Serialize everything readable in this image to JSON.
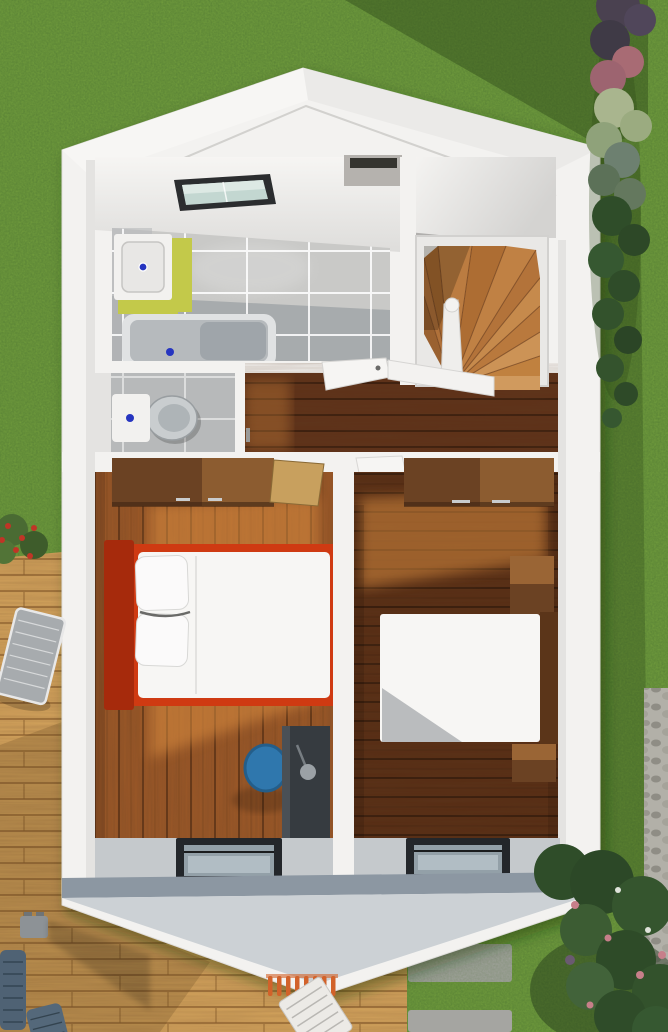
{
  "scene": {
    "description": "3D aerial dollhouse cutaway render of the upper storey of a small gabled house, surrounded by lawn, a timber deck, paving and hedges",
    "view": "top-down cutaway",
    "rooms": [
      {
        "id": "bathroom",
        "contents": [
          "skylight",
          "vanity-sink",
          "bathtub"
        ]
      },
      {
        "id": "wc",
        "contents": [
          "toilet"
        ]
      },
      {
        "id": "stairwell",
        "contents": [
          "winder-staircase",
          "newel-post",
          "balustrade"
        ]
      },
      {
        "id": "landing",
        "contents": [
          "open-door"
        ]
      },
      {
        "id": "bedroom-left",
        "contents": [
          "wardrobe",
          "double-bed-red-frame",
          "desk",
          "blue-chair",
          "front-window"
        ]
      },
      {
        "id": "bedroom-right",
        "contents": [
          "wardrobe",
          "double-bed",
          "nightstands",
          "front-window"
        ]
      }
    ],
    "exterior": [
      "lawn",
      "timber-deck",
      "sun-loungers",
      "wicker-chairs",
      "stone-pavers",
      "gravel-path",
      "hedge-row",
      "flowering-bushes"
    ]
  },
  "colors": {
    "grass": "#76a23e",
    "grassShadow": "#2c4517",
    "deck": "#d3a35c",
    "deckShadow": "#5b3f1c",
    "paver": "#a5a5a1",
    "gravel": "#b2b0a8",
    "house": "#f3f2f0",
    "roofLeft": "#f7f6f4",
    "roofRight": "#ebeae8",
    "ceiling": "#f2f1ef",
    "ceilingShade": "#dcdbd9",
    "innerWall": "#e4e3e1",
    "tileLight": "#c9c9c7",
    "tileMid": "#b7b9ba",
    "tileDark": "#a3a7aa",
    "grout": "#ffffff",
    "tubOuter": "#e0e2e3",
    "tubInner": "#b6babd",
    "tubShadow": "#9aa0a5",
    "porcelain": "#f2f1ef",
    "sinkGreen": "#c3c94a",
    "basin": "#e8e7e5",
    "fixtureBlue": "#2635c0",
    "toiletBowl": "#c9cdcf",
    "skylightFrame": "#2b2d2f",
    "skylightGlass": "#c3d7d1",
    "skylightGlassLight": "#dde9e4",
    "chimney": "#b5b2ae",
    "chimneySlot": "#35342f",
    "stairColors": [
      "#9a6130",
      "#b0713a",
      "#a5672f",
      "#bb7c41",
      "#ad6d33",
      "#c08144",
      "#b3733a",
      "#c68a4c",
      "#b9793d",
      "#cc9356",
      "#c0813f",
      "#d09a5e"
    ],
    "stairEdge": "#6e3f1c",
    "newel": "#efeeec",
    "hallWood": "#5e3118",
    "b1Floor": "#9b5827",
    "b2Floor": "#572d14",
    "sunlight": "#e09243",
    "wardrobeDark": "#6b4223",
    "wardrobeLight": "#8c5c30",
    "doorTan": "#c8a05e",
    "doorWhite": "#f6f5f3",
    "handleMetal": "#c9ccce",
    "bedRed": "#cf3a12",
    "bedRedDark": "#a62a0c",
    "duvet": "#f7f6f4",
    "pillow": "#fbfafa",
    "desk": "#363b40",
    "chairBlue": "#2f77ad",
    "lampGray": "#9ba1a6",
    "headboardWood": "#5b3519",
    "nightstand": "#6b4223",
    "nightstandTop": "#9a6535",
    "windowFrame": "#23262a",
    "windowGlass": "#93a0a8",
    "windowGlassLight": "#b9c4ca",
    "bandGray": "#c5c9cc",
    "slopeBand": "#8c97a2",
    "slope": "#ccd1d5",
    "lounger": "#a7abae",
    "wicker": "#4f6274",
    "stool": "#8d9296",
    "whiteLounger": "#eceae6",
    "ladderOrange": "#d2622a",
    "bushDark": "#2f4d29",
    "bushGreen": "#3c5c33",
    "bushSage": "#a9b58e",
    "bushPink": "#a86b74",
    "bushPurple": "#4a4150",
    "flowerRed": "#c03526",
    "flowerPink": "#c77f8a"
  }
}
